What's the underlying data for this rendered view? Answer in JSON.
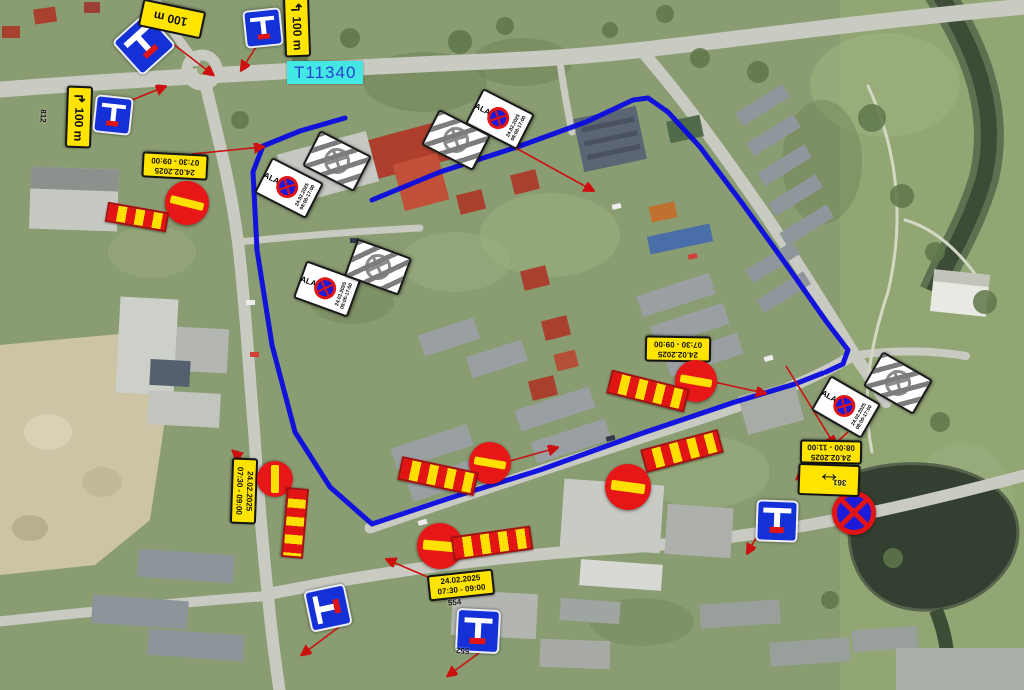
{
  "map": {
    "road_ref": "T11340",
    "route_color": "#0b0be0",
    "leader_color": "#cc1111"
  },
  "signs": {
    "zone_no_stopping": {
      "word": "ALA",
      "date": "24.02.2025",
      "time": "08:00-17:00"
    },
    "distance_plates": [
      {
        "arrow": "",
        "label": "100 m"
      },
      {
        "arrow": "↰",
        "label": "100 m"
      },
      {
        "arrow": "↱",
        "label": "100 m"
      }
    ],
    "date_plates": [
      {
        "date": "24.02.2025",
        "time": "07:30 - 09:00"
      },
      {
        "date": "24.02.2025",
        "time": "07:30 - 09:00"
      },
      {
        "date": "24.02.2025",
        "time": "07:30 - 09:00"
      },
      {
        "date": "24.02.2025",
        "time": "08:00 - 11:00"
      },
      {
        "date": "24.02.2025",
        "time": "07:30 - 09:00"
      }
    ],
    "two_way_plate": {
      "glyph": "↔"
    },
    "codes": {
      "distance_plate": "812",
      "dead_end": "552",
      "no_stopping": "361",
      "closure": "554"
    }
  }
}
